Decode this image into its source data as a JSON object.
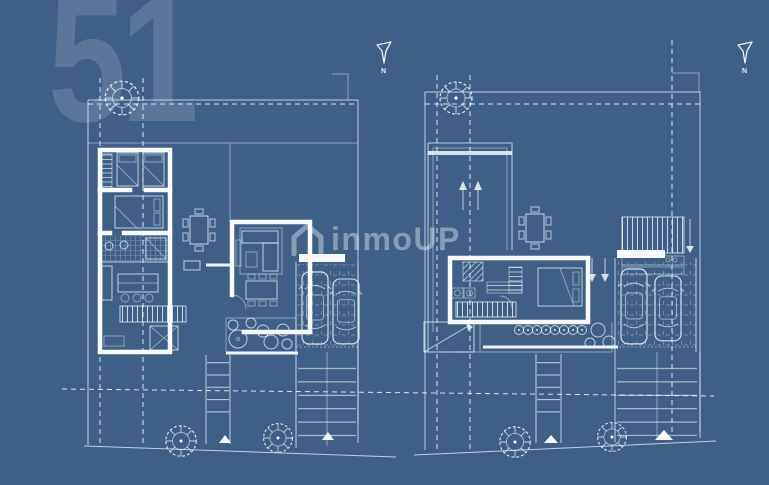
{
  "canvas": {
    "description": "real-estate blueprint of two villa floor plans on blue sky background",
    "background_top": "#4c6d94",
    "background_mid": "#5a7ead",
    "background_bottom": "#95b6d9",
    "line_color": "#ffffff"
  },
  "watermarks": {
    "plan_number": "51",
    "plan_number_color": "rgba(255,255,255,0.15)",
    "brand": "inmoUP",
    "brand_icon": "house-icon",
    "brand_color": "rgba(255,255,255,0.38)"
  },
  "plans": [
    {
      "id": "ground-floor-plan",
      "north_label": "N",
      "icons": [
        "north-arrow-icon",
        "tree-icon",
        "twin-bed-icon",
        "double-bed-icon",
        "bathtub-icon",
        "kitchen-island-icon",
        "sofa-icon",
        "dining-table-icon",
        "stairs-icon",
        "car-icon",
        "car-icon",
        "planter-icon",
        "entrance-triangle-icon"
      ]
    },
    {
      "id": "upper-floor-plan",
      "north_label": "N",
      "icons": [
        "north-arrow-icon",
        "tree-icon",
        "double-bed-icon",
        "stairs-icon",
        "up-arrows-icon",
        "down-arrows-icon",
        "pergola-slats-icon",
        "dining-table-icon",
        "car-icon",
        "car-icon",
        "planter-icon",
        "entrance-triangle-icon"
      ]
    }
  ]
}
